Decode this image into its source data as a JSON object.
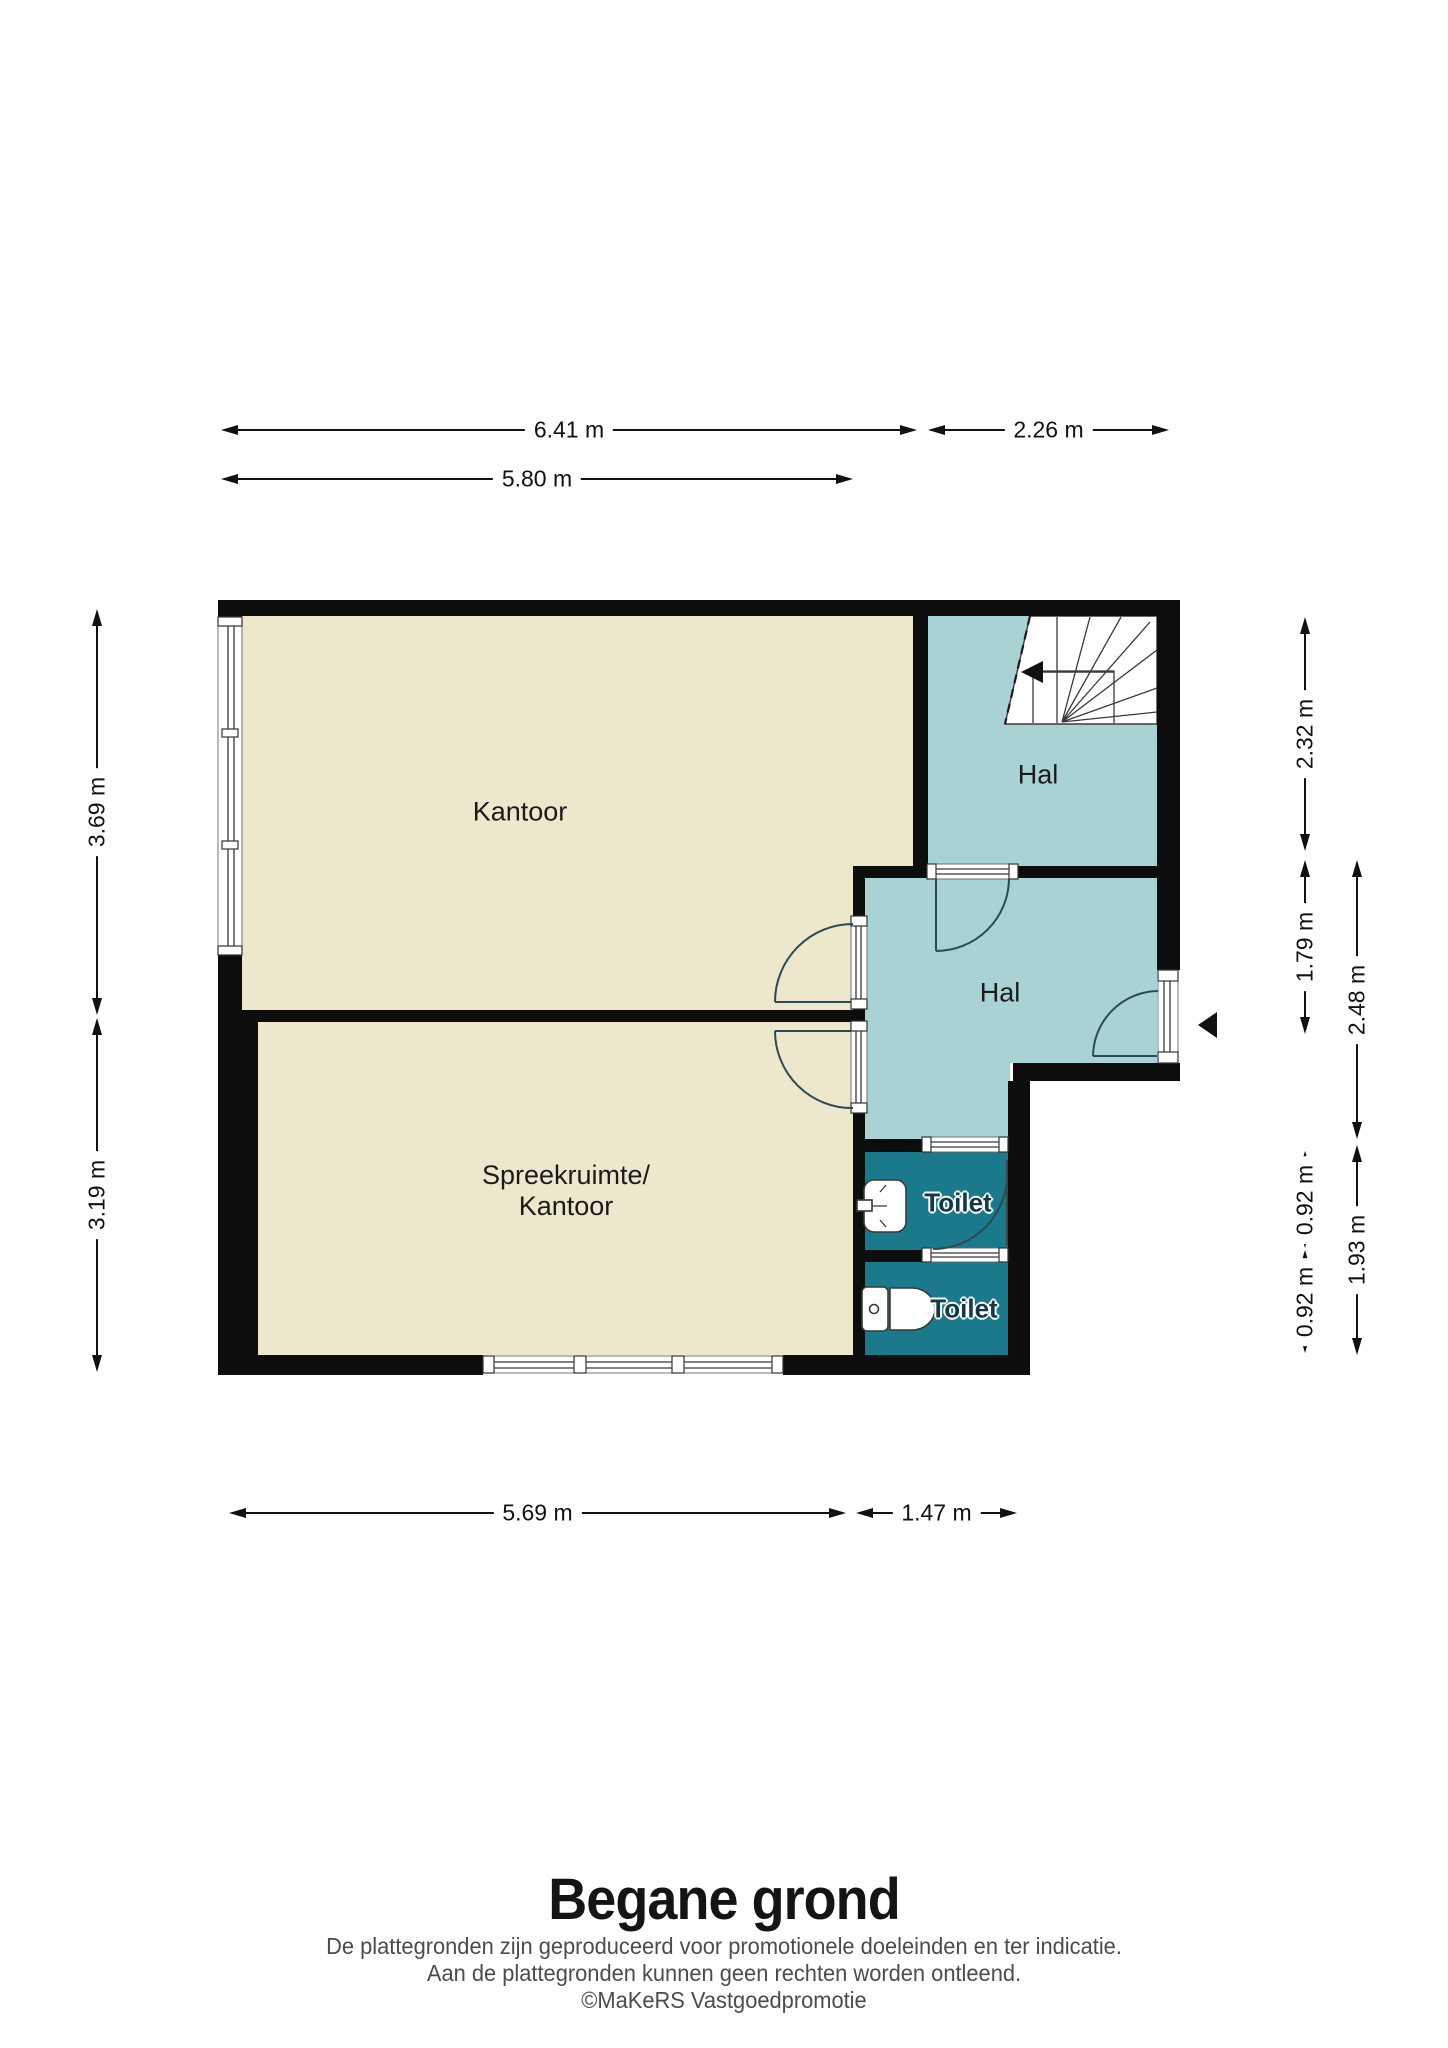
{
  "title": {
    "text": "Begane grond"
  },
  "footer": {
    "line1": "De plattegronden zijn geproduceerd voor promotionele doeleinden en ter indicatie.",
    "line2": "Aan de plattegronden kunnen geen rechten worden ontleend.",
    "line3": "©MaKeRS Vastgoedpromotie"
  },
  "rooms": {
    "kantoor": "Kantoor",
    "spreekruimte_line1": "Spreekruimte/",
    "spreekruimte_line2": "Kantoor",
    "hal_top": "Hal",
    "hal_mid": "Hal",
    "toilet_top": "Toilet",
    "toilet_bottom": "Toilet"
  },
  "dimensions": {
    "width_total": "6.41 m",
    "width_right": "2.26 m",
    "width_kantoor": "5.80 m",
    "height_kantoor": "3.69 m",
    "height_spreekruimte": "3.19 m",
    "height_hal_top": "2.32 m",
    "height_hal_mid": "1.79 m",
    "height_hal_full": "2.48 m",
    "height_toilet_top": "0.92 m",
    "height_toilet_bottom": "0.92 m",
    "height_toilets_total": "1.93 m",
    "width_bottom_left": "5.69 m",
    "width_bottom_right": "1.47 m"
  },
  "colors": {
    "wall": "#0D0D0D",
    "room": "#EDE7CC",
    "hall": "#A8D2D4",
    "toilet": "#1A7A8C"
  }
}
